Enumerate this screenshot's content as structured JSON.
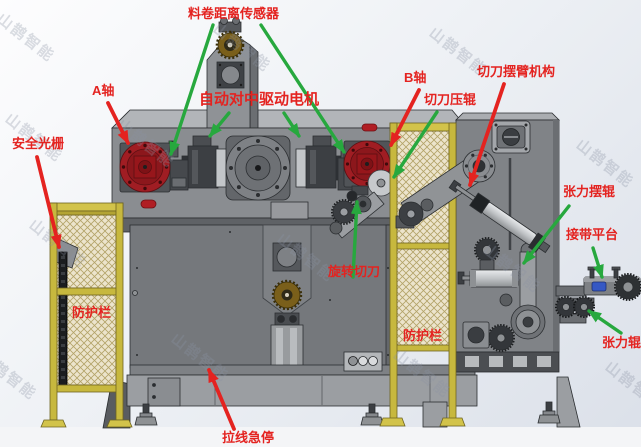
{
  "watermark": {
    "text": "山鹊智能"
  },
  "labels": [
    {
      "id": "material-roll-distance-sensor",
      "text": "料卷距离传感器"
    },
    {
      "id": "a-axis",
      "text": "A轴"
    },
    {
      "id": "auto-centering-drive-motor",
      "text": "自动对中驱动电机"
    },
    {
      "id": "b-axis",
      "text": "B轴"
    },
    {
      "id": "cutter-pressure-roller",
      "text": "切刀压辊"
    },
    {
      "id": "cutter-swing-arm-mechanism",
      "text": "切刀摆臂机构"
    },
    {
      "id": "safety-light-curtain",
      "text": "安全光栅"
    },
    {
      "id": "protective-fence-left",
      "text": "防护栏"
    },
    {
      "id": "rotary-cutter",
      "text": "旋转切刀"
    },
    {
      "id": "protective-fence-right",
      "text": "防护栏"
    },
    {
      "id": "tension-swing-roller",
      "text": "张力摆辊"
    },
    {
      "id": "splicing-platform",
      "text": "接带平台"
    },
    {
      "id": "tension-roller",
      "text": "张力辊"
    },
    {
      "id": "pull-wire-emergency-stop",
      "text": "拉线急停"
    }
  ],
  "colors": {
    "label": "#e42320",
    "arrow_red": "#e42320",
    "arrow_green": "#27a83e",
    "axis_flange_red": "#a01d23",
    "fence_yellow": "#c7b83e",
    "splice_block_blue": "#3558c4",
    "watermark_grey": "#8b93a4"
  }
}
